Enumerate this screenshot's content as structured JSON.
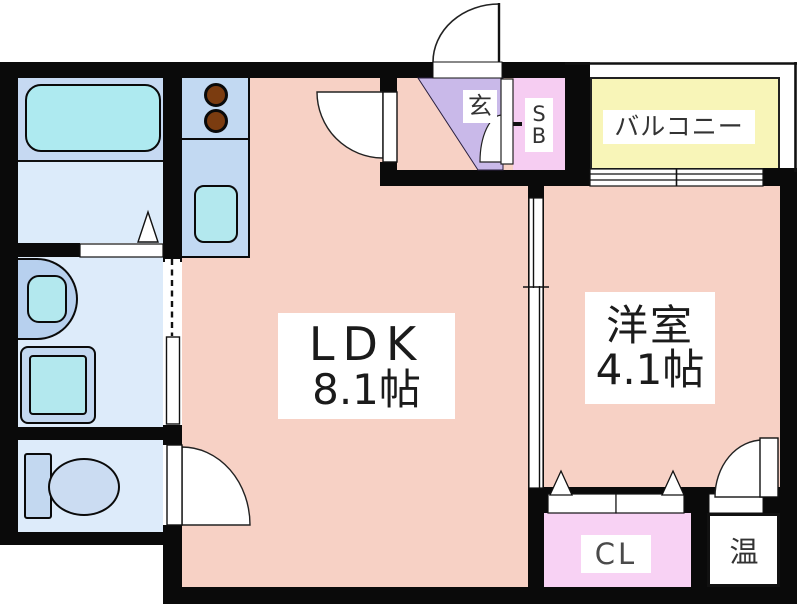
{
  "plan": {
    "rooms": {
      "ldk": {
        "name": "LDK",
        "size": "8.1帖"
      },
      "western_room": {
        "name": "洋室",
        "size": "4.1帖"
      },
      "balcony": {
        "name": "バルコニー"
      },
      "entrance": {
        "name": "玄"
      },
      "shoe_box": {
        "line1": "S",
        "line2": "B"
      },
      "closet": {
        "name": "CL"
      },
      "water_heater": {
        "name": "温"
      }
    },
    "fixtures": {
      "bathtub": "bathtub",
      "washbasin": "washbasin",
      "washing_machine_pan": "washing-machine-pan",
      "toilet": "toilet",
      "stove_burners": "stove-burners",
      "kitchen_sink": "kitchen-sink"
    },
    "colors": {
      "room_pink": "#f7d1c5",
      "kitchen_blue": "#c2d9f2",
      "bath_blue": "#c6d9f2",
      "floor_blue": "#ddebfa",
      "fixture_cyan": "#b0e9ef",
      "entrance_lavender": "#c9b9e9",
      "shoebox_pink": "#f6cdf2",
      "closet_pink": "#f8d2f4",
      "balcony_yellow": "#f8f5b8",
      "burner_brown": "#7b3c10",
      "wall_black": "#0a0a0a"
    }
  }
}
